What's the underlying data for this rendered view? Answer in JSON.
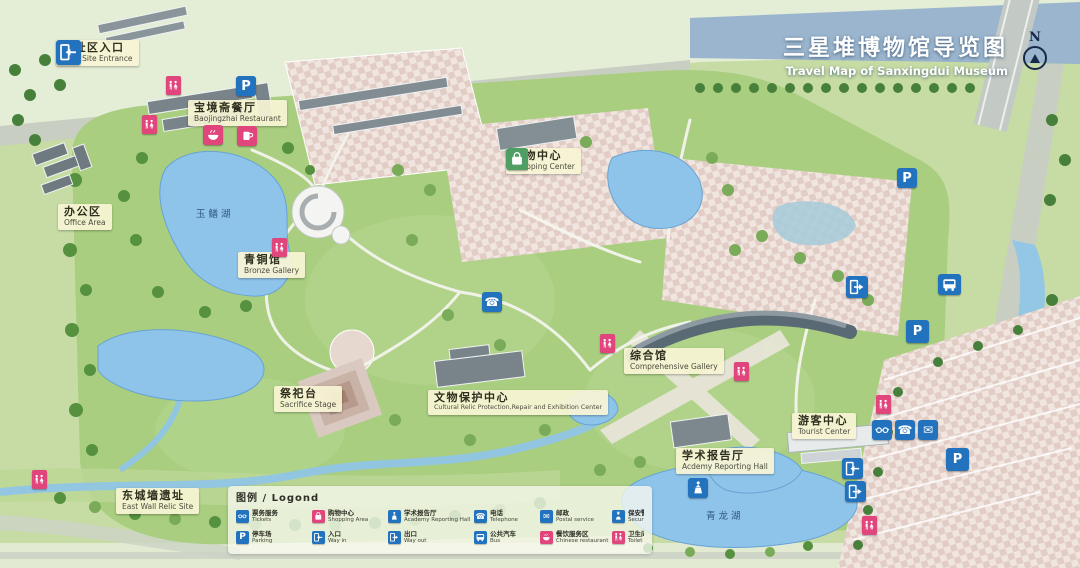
{
  "title": {
    "zh": "三星堆博物馆导览图",
    "en": "Travel Map of Sanxingdui Museum"
  },
  "compass": {
    "label": "N"
  },
  "places": {
    "relic_entrance": {
      "zh": "遗址区入口",
      "en": "Relic Site Entrance"
    },
    "baojingzhai": {
      "zh": "宝境斋餐厅",
      "en": "Baojingzhai Restaurant"
    },
    "office": {
      "zh": "办公区",
      "en": "Office Area"
    },
    "shopping": {
      "zh": "购物中心",
      "en": "Shopping Center"
    },
    "bronze": {
      "zh": "青铜馆",
      "en": "Bronze Gallery"
    },
    "sacrifice": {
      "zh": "祭祀台",
      "en": "Sacrifice Stage"
    },
    "relic_protection": {
      "zh": "文物保护中心",
      "en": "Cultural Relic Protection,Repair and Exhibition Center"
    },
    "comprehensive": {
      "zh": "综合馆",
      "en": "Comprehensive Gallery"
    },
    "academy": {
      "zh": "学术报告厅",
      "en": "Acdemy Reporting Hall"
    },
    "tourist": {
      "zh": "游客中心",
      "en": "Tourist Center"
    },
    "east_wall": {
      "zh": "东城墙遗址",
      "en": "East Wall Relic Site"
    }
  },
  "lakes": {
    "yushan": "玉鳝湖",
    "qinglong": "青龙湖"
  },
  "legend": {
    "title": "图例 / Logond",
    "items": [
      {
        "zh": "票务服务",
        "en": "Tickets"
      },
      {
        "zh": "购物中心",
        "en": "Shopping Area"
      },
      {
        "zh": "学术报告厅",
        "en": "Academy Reporting Hall"
      },
      {
        "zh": "电话",
        "en": "Telephone"
      },
      {
        "zh": "邮政",
        "en": "Postal service"
      },
      {
        "zh": "保安警务",
        "en": "Security Police"
      },
      {
        "zh": "停车场",
        "en": "Parking"
      },
      {
        "zh": "入口",
        "en": "Way in"
      },
      {
        "zh": "出口",
        "en": "Way out"
      },
      {
        "zh": "公共汽车",
        "en": "Bus"
      },
      {
        "zh": "餐饮服务区",
        "en": "Chinese restaurant"
      },
      {
        "zh": "卫生间",
        "en": "Toilet"
      }
    ]
  },
  "icons": {
    "parking_letter": "P",
    "phone_glyph": "☎",
    "mail_glyph": "✉"
  },
  "colors": {
    "label_bg": "#f7f4d4",
    "icon_blue": "#2272bd",
    "icon_pink": "#e0457b",
    "icon_green": "#4f9e63",
    "water": "#8ec4ea",
    "title_text": "#ffffff"
  }
}
